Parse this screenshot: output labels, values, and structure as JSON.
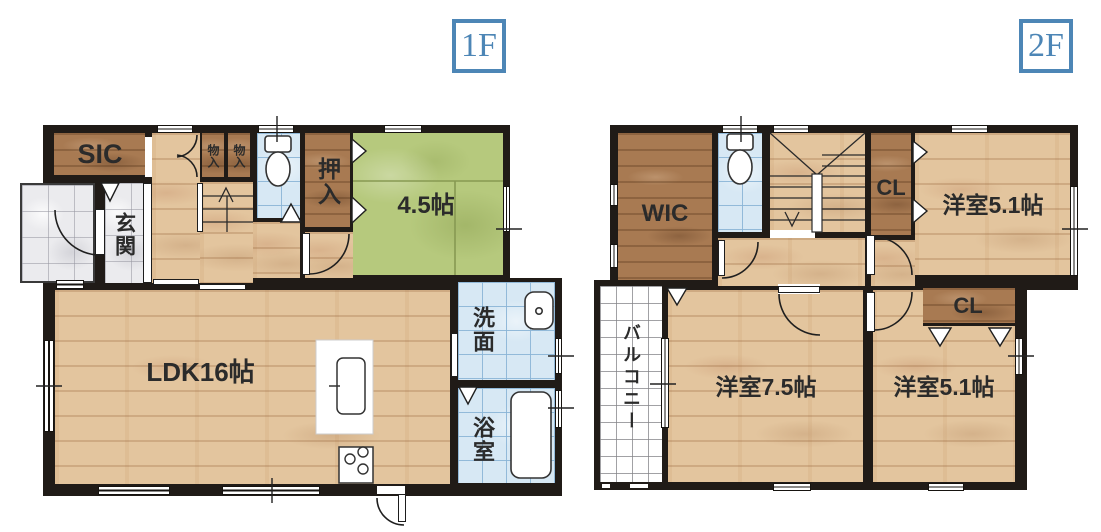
{
  "f1": {
    "badge": "1F",
    "sic": "SIC",
    "genkan": "玄関",
    "mono1": "物入",
    "mono2": "物入",
    "oshiire": "押入",
    "tatami_room": "4.5帖",
    "ldk": "LDK16帖",
    "senmen": "洗面",
    "bath": "浴室"
  },
  "f2": {
    "badge": "2F",
    "wic": "WIC",
    "cl_top": "CL",
    "cl_bottom": "CL",
    "room_right_top": "洋室5.1帖",
    "room_left": "洋室7.5帖",
    "room_right_bottom": "洋室5.1帖",
    "balcony": "バルコニー"
  },
  "colors": {
    "wall": "#201b17",
    "wood_light": "#e3c59e",
    "wood_dark": "#a87a52",
    "tatami": "#b6c97d",
    "tile_blue": "#d7e8f4",
    "tile_gray": "#ebebee",
    "accent_blue": "#4d86b6",
    "text": "#2b2b2b"
  }
}
